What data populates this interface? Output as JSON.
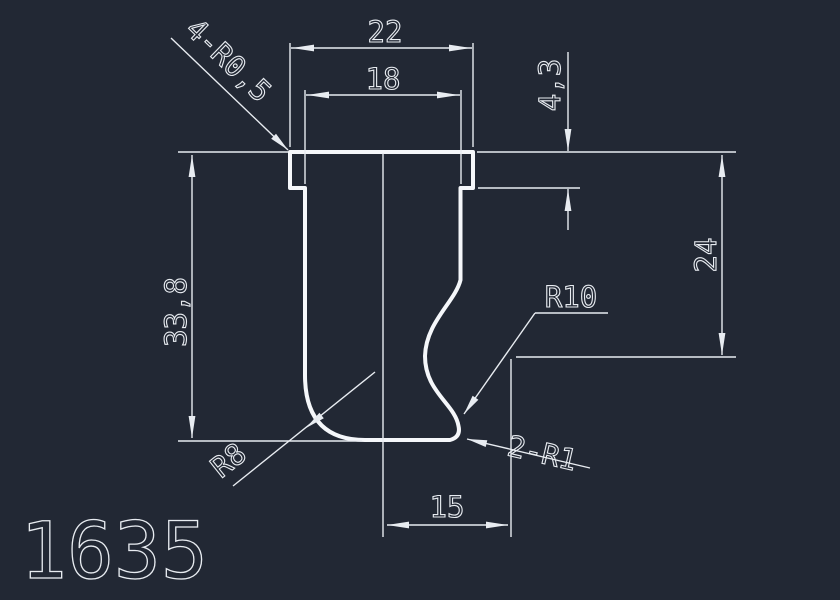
{
  "drawing": {
    "part_number": "1635",
    "dimensions": {
      "outer_width": "22",
      "inner_width": "18",
      "flange_depth": "4,3",
      "side_height": "24",
      "overall_height": "33,8",
      "bottom_offset": "15"
    },
    "annotations": {
      "corner_fillets": "4-R0,5",
      "concave_radius": "R10",
      "edge_fillets": "2-R1",
      "base_fillet": "R8"
    },
    "colors": {
      "bg": "#222834",
      "line": "#e8ecf1",
      "profile": "#f5f7fa"
    }
  }
}
